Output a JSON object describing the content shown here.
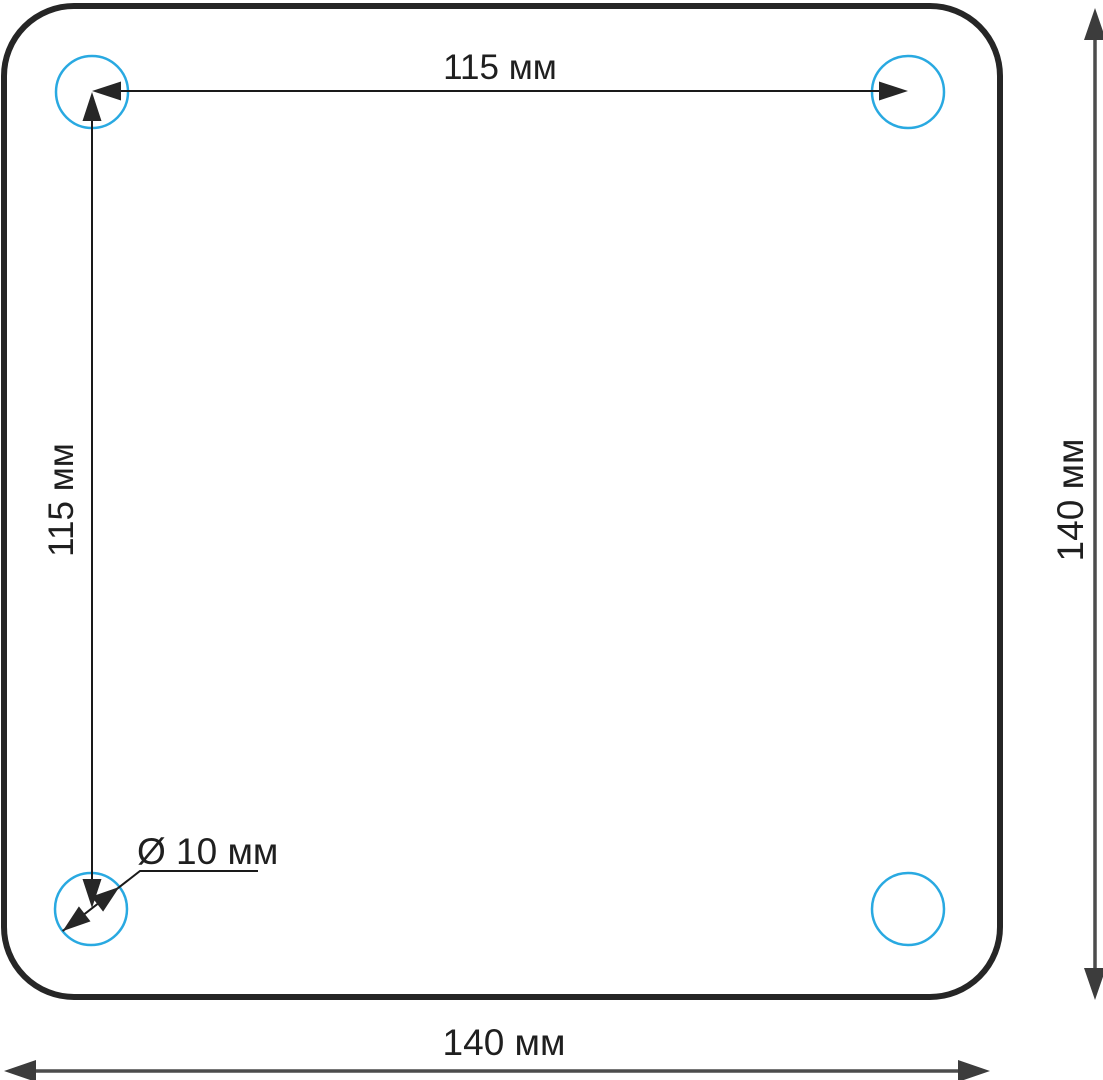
{
  "drawing": {
    "unit": "мм",
    "plate": {
      "width_mm": 140,
      "height_mm": 140,
      "corner_style": "rounded"
    },
    "holes": {
      "count": 4,
      "diameter_mm": 10,
      "spacing_horizontal_mm": 115,
      "spacing_vertical_mm": 115
    }
  },
  "dimensions": {
    "hole_spacing_horizontal": {
      "label": "115 мм",
      "value_mm": 115
    },
    "hole_spacing_vertical": {
      "label": "115 мм",
      "value_mm": 115
    },
    "plate_height": {
      "label": "140 мм",
      "value_mm": 140
    },
    "plate_width": {
      "label": "140 мм",
      "value_mm": 140
    },
    "hole_diameter": {
      "label": "Ø 10 мм",
      "value_mm": 10
    }
  },
  "colors": {
    "background": "#ffffff",
    "plate_outline": "#262626",
    "hole_circle": "#29a9e1",
    "dimension_primary": "#1a1a1a",
    "dimension_secondary": "#4c4c4c",
    "text": "#1f1f1f"
  }
}
